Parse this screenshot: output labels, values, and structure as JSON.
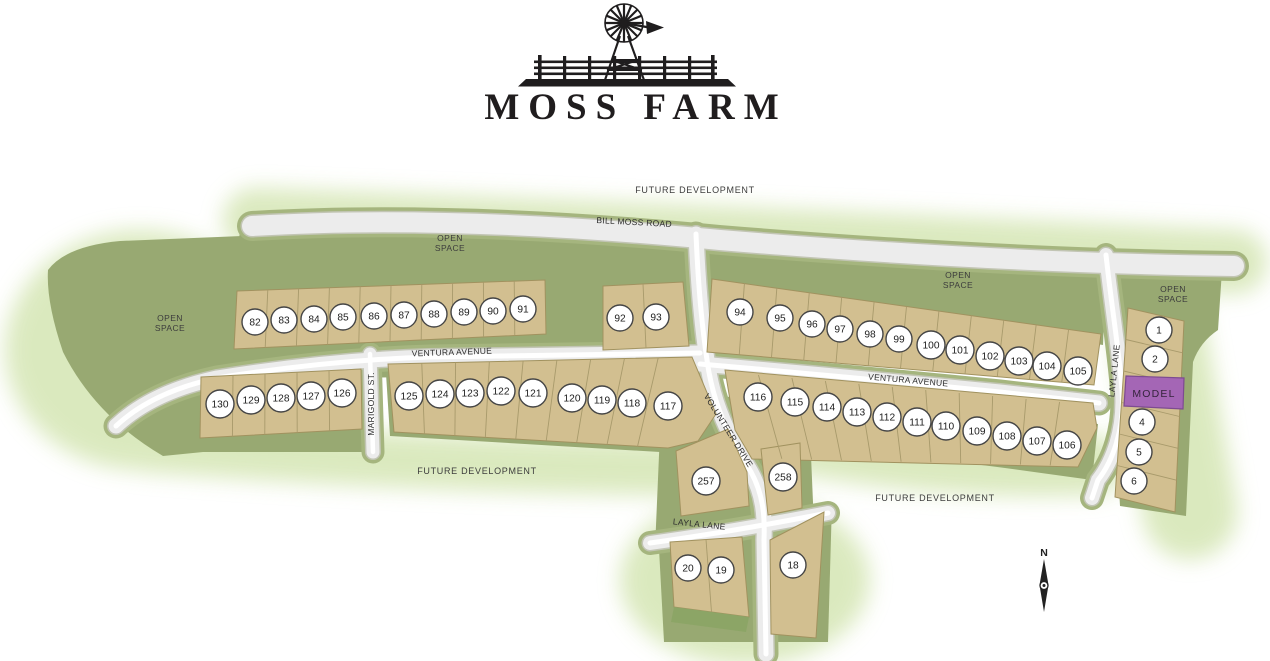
{
  "title": "MOSS FARM",
  "labels": {
    "future_development": "FUTURE DEVELOPMENT",
    "open": "OPEN",
    "space": "SPACE",
    "model": "MODEL",
    "north": "N"
  },
  "roads": {
    "bill_moss": "BILL MOSS ROAD",
    "ventura": "VENTURA AVENUE",
    "marigold": "MARIGOLD ST.",
    "volunteer": "VOLUNTEER DRIVE",
    "layla": "LAYLA LANE"
  },
  "colors": {
    "lot_fill": "#d2bf90",
    "lot_line": "#a1925f",
    "lot_division": "#a89a6b",
    "open_space": "#98a972",
    "open_space_dark": "#8ca566",
    "road_fill": "#ececec",
    "road_buffer": "#a5b57e",
    "road_edge": "#c2c5b4",
    "model_fill": "#a466b5",
    "model_border": "#7d4b91",
    "glow": "#d7e7b8",
    "ink": "#3c3c3c"
  },
  "lots": [
    {
      "n": "82",
      "x": 255,
      "y": 322
    },
    {
      "n": "83",
      "x": 284,
      "y": 320
    },
    {
      "n": "84",
      "x": 314,
      "y": 319
    },
    {
      "n": "85",
      "x": 343,
      "y": 317
    },
    {
      "n": "86",
      "x": 374,
      "y": 316
    },
    {
      "n": "87",
      "x": 404,
      "y": 315
    },
    {
      "n": "88",
      "x": 434,
      "y": 314
    },
    {
      "n": "89",
      "x": 464,
      "y": 312
    },
    {
      "n": "90",
      "x": 493,
      "y": 311
    },
    {
      "n": "91",
      "x": 523,
      "y": 309
    },
    {
      "n": "92",
      "x": 620,
      "y": 318
    },
    {
      "n": "93",
      "x": 656,
      "y": 317
    },
    {
      "n": "94",
      "x": 740,
      "y": 312
    },
    {
      "n": "95",
      "x": 780,
      "y": 318
    },
    {
      "n": "96",
      "x": 812,
      "y": 324
    },
    {
      "n": "97",
      "x": 840,
      "y": 329
    },
    {
      "n": "98",
      "x": 870,
      "y": 334
    },
    {
      "n": "99",
      "x": 899,
      "y": 339
    },
    {
      "n": "100",
      "x": 931,
      "y": 345
    },
    {
      "n": "101",
      "x": 960,
      "y": 350
    },
    {
      "n": "102",
      "x": 990,
      "y": 356
    },
    {
      "n": "103",
      "x": 1019,
      "y": 361
    },
    {
      "n": "104",
      "x": 1047,
      "y": 366
    },
    {
      "n": "105",
      "x": 1078,
      "y": 371
    },
    {
      "n": "1",
      "x": 1159,
      "y": 330
    },
    {
      "n": "2",
      "x": 1155,
      "y": 359
    },
    {
      "n": "4",
      "x": 1142,
      "y": 422
    },
    {
      "n": "5",
      "x": 1139,
      "y": 452
    },
    {
      "n": "6",
      "x": 1134,
      "y": 481
    },
    {
      "n": "130",
      "x": 220,
      "y": 404
    },
    {
      "n": "129",
      "x": 251,
      "y": 400
    },
    {
      "n": "128",
      "x": 281,
      "y": 398
    },
    {
      "n": "127",
      "x": 311,
      "y": 396
    },
    {
      "n": "126",
      "x": 342,
      "y": 393
    },
    {
      "n": "125",
      "x": 409,
      "y": 396
    },
    {
      "n": "124",
      "x": 440,
      "y": 394
    },
    {
      "n": "123",
      "x": 470,
      "y": 393
    },
    {
      "n": "122",
      "x": 501,
      "y": 391
    },
    {
      "n": "121",
      "x": 533,
      "y": 393
    },
    {
      "n": "120",
      "x": 572,
      "y": 398
    },
    {
      "n": "119",
      "x": 602,
      "y": 400
    },
    {
      "n": "118",
      "x": 632,
      "y": 403
    },
    {
      "n": "117",
      "x": 668,
      "y": 406
    },
    {
      "n": "116",
      "x": 758,
      "y": 397
    },
    {
      "n": "115",
      "x": 795,
      "y": 402
    },
    {
      "n": "114",
      "x": 827,
      "y": 407
    },
    {
      "n": "113",
      "x": 857,
      "y": 412
    },
    {
      "n": "112",
      "x": 887,
      "y": 417
    },
    {
      "n": "111",
      "x": 917,
      "y": 422
    },
    {
      "n": "110",
      "x": 946,
      "y": 426
    },
    {
      "n": "109",
      "x": 977,
      "y": 431
    },
    {
      "n": "108",
      "x": 1007,
      "y": 436
    },
    {
      "n": "107",
      "x": 1037,
      "y": 441
    },
    {
      "n": "106",
      "x": 1067,
      "y": 445
    },
    {
      "n": "257",
      "x": 706,
      "y": 481
    },
    {
      "n": "258",
      "x": 783,
      "y": 477
    },
    {
      "n": "20",
      "x": 688,
      "y": 568
    },
    {
      "n": "19",
      "x": 721,
      "y": 570
    },
    {
      "n": "18",
      "x": 793,
      "y": 565
    }
  ]
}
